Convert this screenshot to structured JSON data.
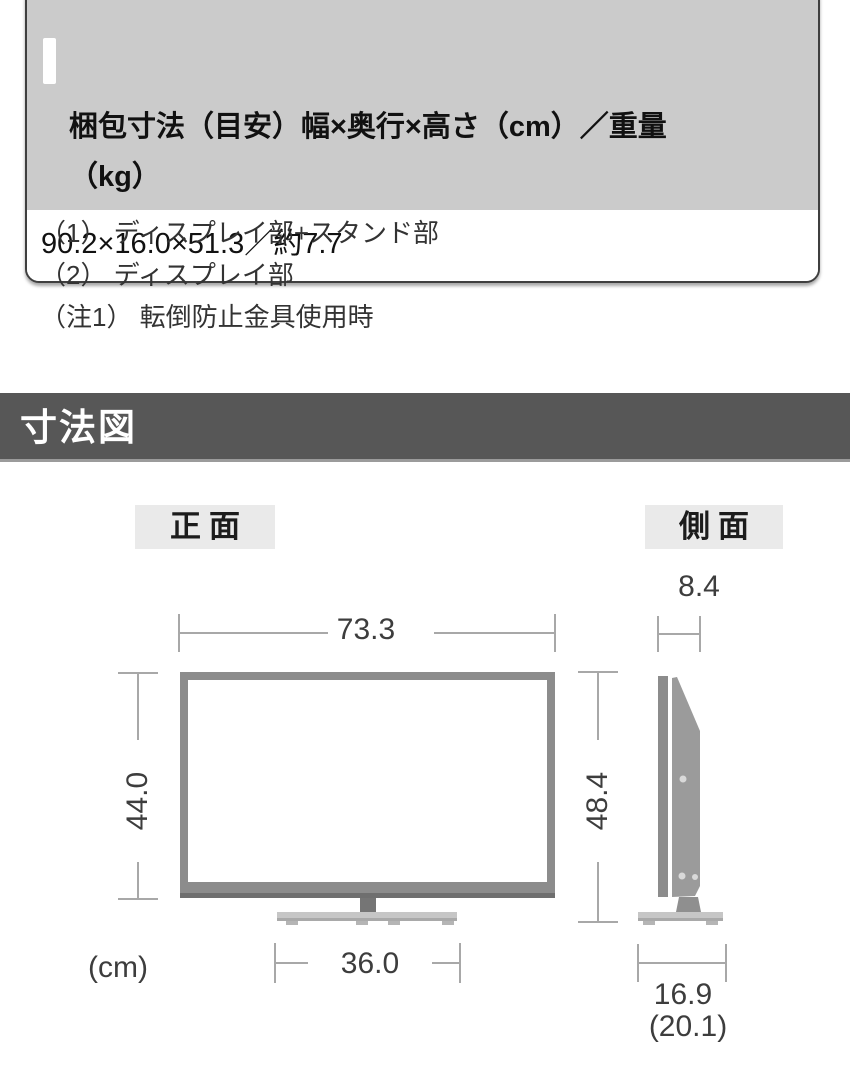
{
  "spec_card": {
    "header": "梱包寸法（目安）幅×奥行×高さ（cm）／重量\n（kg）",
    "value": "90.2×16.0×51.3／約7.7"
  },
  "notes": [
    "（1） ディスプレイ部+スタンド部",
    "（2） ディスプレイ部",
    "（注1） 転倒防止金具使用時"
  ],
  "section": {
    "title": "寸法図"
  },
  "diagram": {
    "front_label": "正面",
    "side_label": "側面",
    "unit": "(cm)",
    "front": {
      "width": "73.3",
      "height": "44.0",
      "total_height": "48.4",
      "stand_width": "36.0"
    },
    "side": {
      "depth": "8.4",
      "stand_depth": "16.9",
      "stand_depth_alt": "(20.1)"
    }
  },
  "colors": {
    "table_header_bg": "#cbcbcb",
    "card_border": "#3f3f3f",
    "section_bar_bg": "#575757",
    "view_label_bg": "#eaeaea",
    "tv_frame_gray": "#8c8c8c",
    "stand_gray": "#c6c6c6",
    "dim_line_gray": "#a8a8a8",
    "dim_text": "#3d3d3d"
  }
}
